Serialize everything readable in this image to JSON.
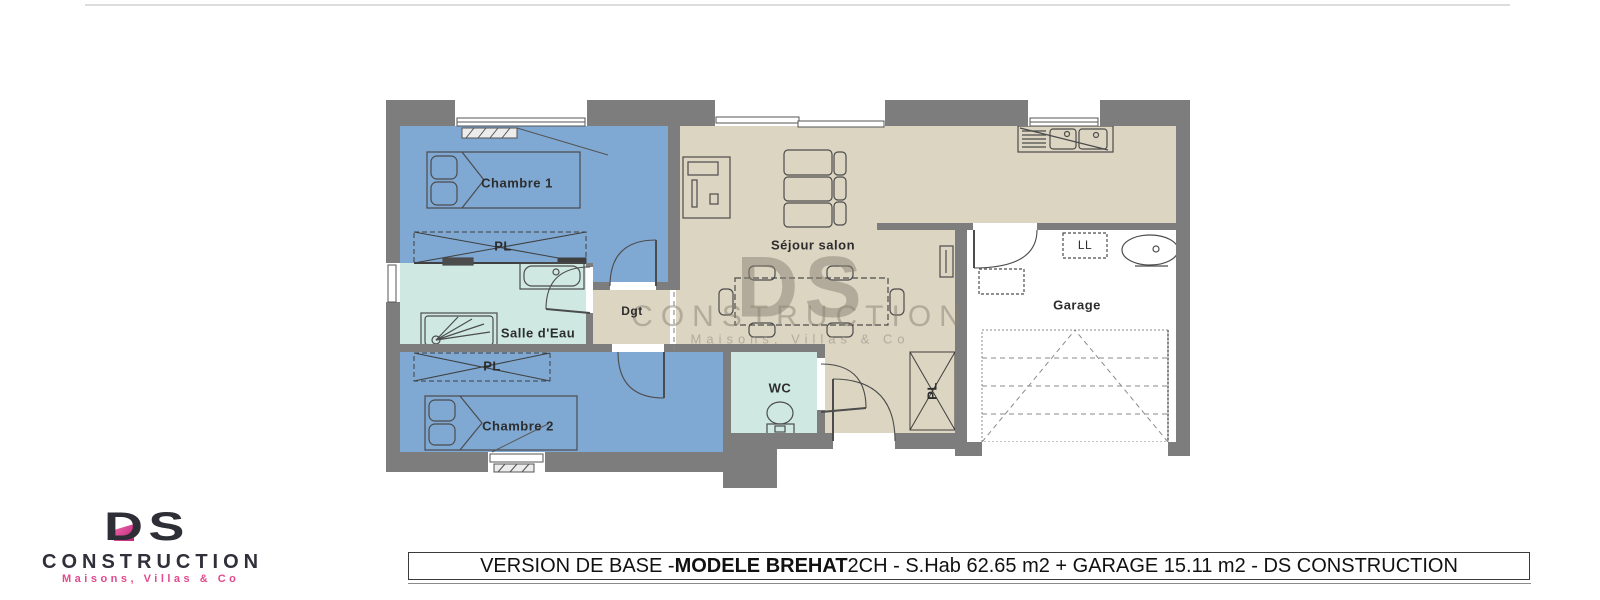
{
  "plan": {
    "rooms": {
      "chambre1": "Chambre 1",
      "chambre2": "Chambre 2",
      "salle_eau": "Salle d'Eau",
      "dgt": "Dgt",
      "wc": "WC",
      "sejour": "Séjour salon",
      "garage": "Garage",
      "pl": "PL",
      "ll": "LL"
    }
  },
  "watermark": {
    "initials": "DS",
    "name": "CONSTRUCTION",
    "tagline": "Maisons, Villas & Co"
  },
  "logo": {
    "initials": "DS",
    "name": "CONSTRUCTION",
    "tagline": "Maisons, Villas & Co"
  },
  "title_bar": {
    "prefix": "VERSION DE BASE - ",
    "model": "MODELE BREHAT",
    "suffix": " 2CH - S.Hab 62.65 m2 + GARAGE 15.11 m2 - DS CONSTRUCTION"
  },
  "colors": {
    "wall": "#7d7d7d",
    "bedroom_blue": "#7fa8d2",
    "bath_mint": "#cfe9e2",
    "living_beige": "#dcd5c2",
    "garage_white": "#ffffff",
    "logo_pink": "#d6498e",
    "logo_dark": "#30303a",
    "watermark_gray": "#8a8173"
  }
}
